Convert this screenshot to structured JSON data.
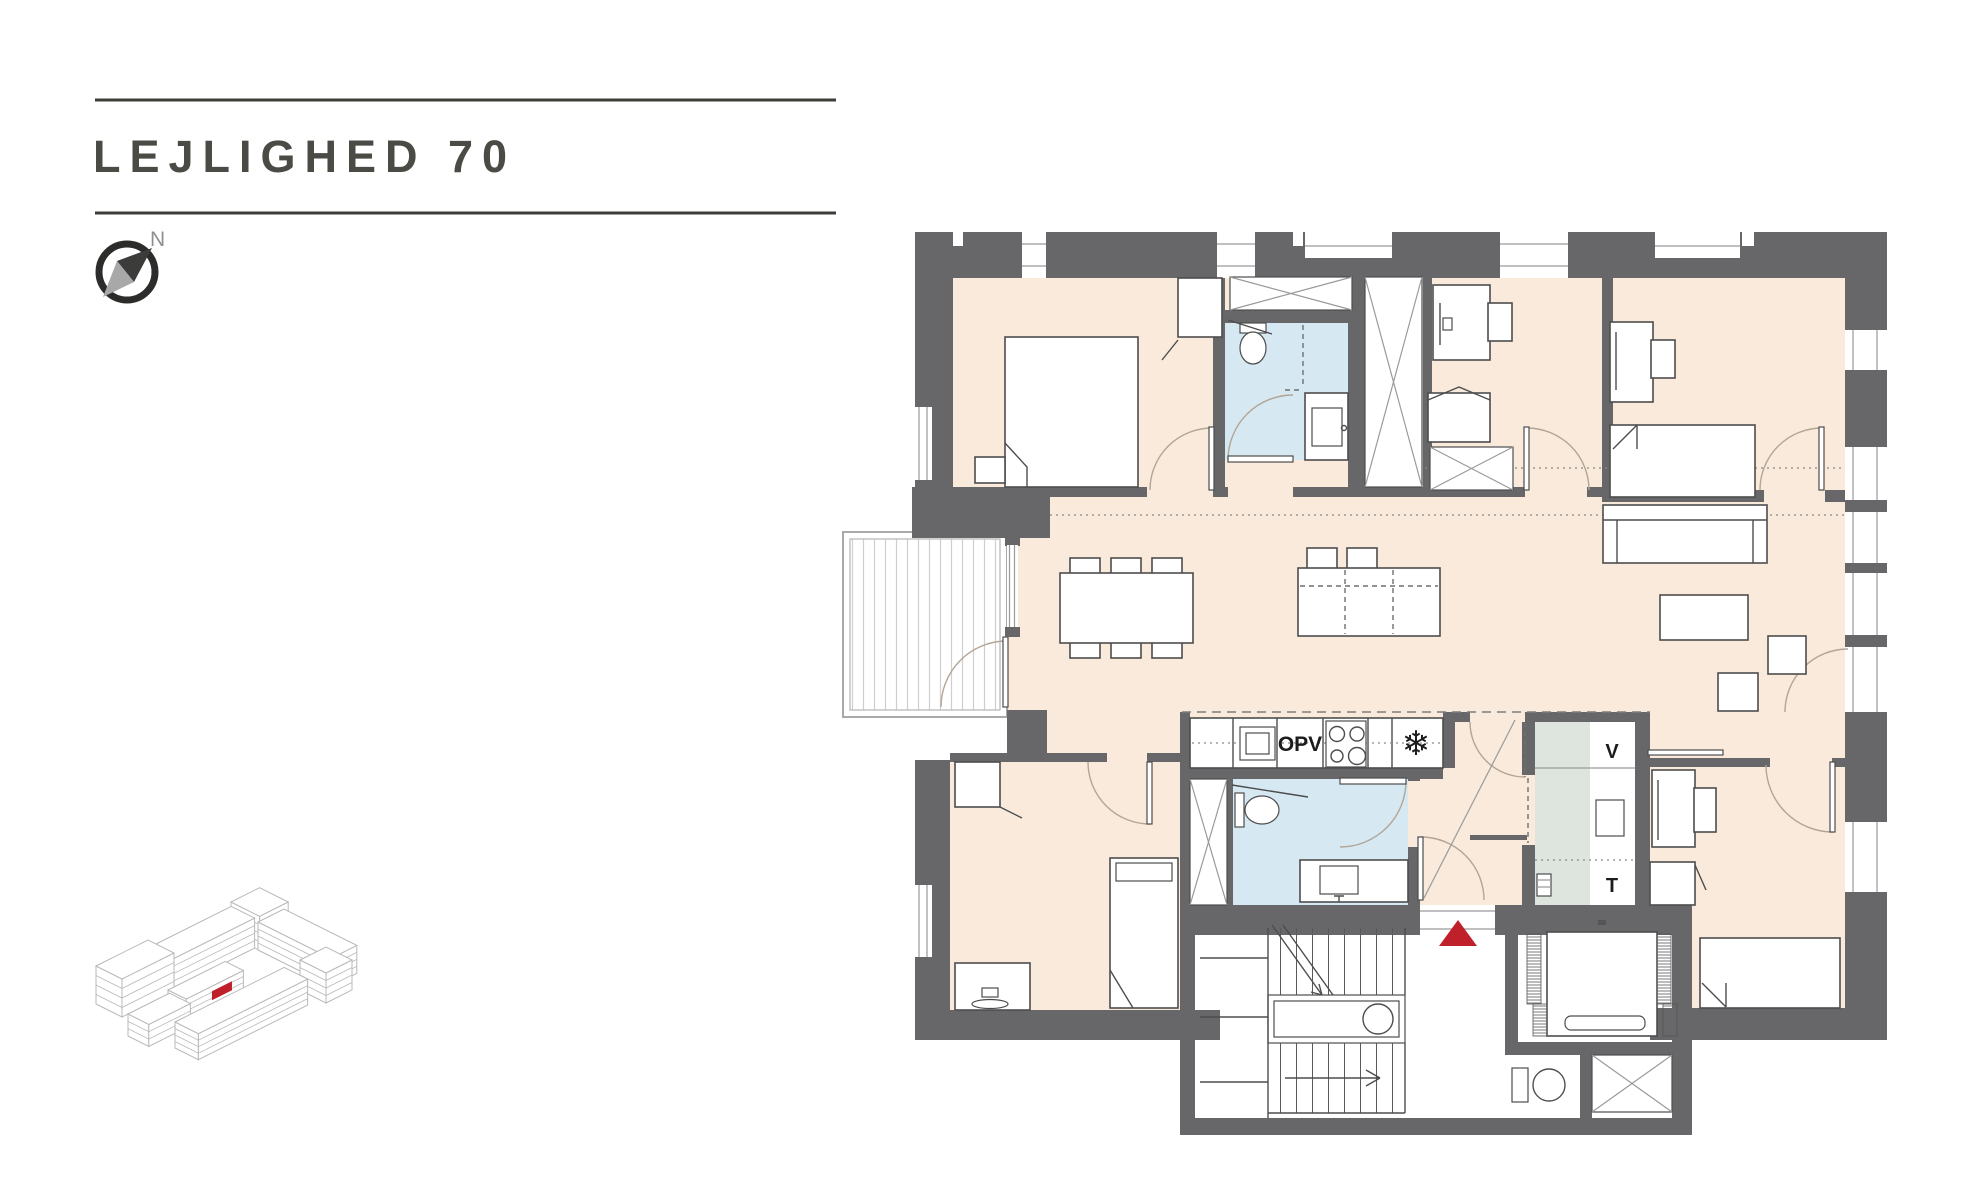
{
  "header": {
    "title": "LEJLIGHED 70"
  },
  "compass": {
    "north_label": "N"
  },
  "floor_plan": {
    "kitchen": {
      "oven_label": "OPV",
      "freezer_icon": "❄"
    },
    "utility": {
      "washer_label": "V",
      "dryer_label": "T"
    },
    "entrance_marker": "red-triangle"
  },
  "site_plan": {
    "highlighted_unit": "apartment 70"
  },
  "colors": {
    "wall": "#67676a",
    "floor": "#f9eadb",
    "bath": "#d6e9f3",
    "utility": "#dde5de",
    "line": "#4d4d4d",
    "lightline": "#9a9a9a",
    "arc": "#b3a596",
    "accent": "#c0202a",
    "title": "#4b4b45",
    "site": "#b9b9b9"
  }
}
